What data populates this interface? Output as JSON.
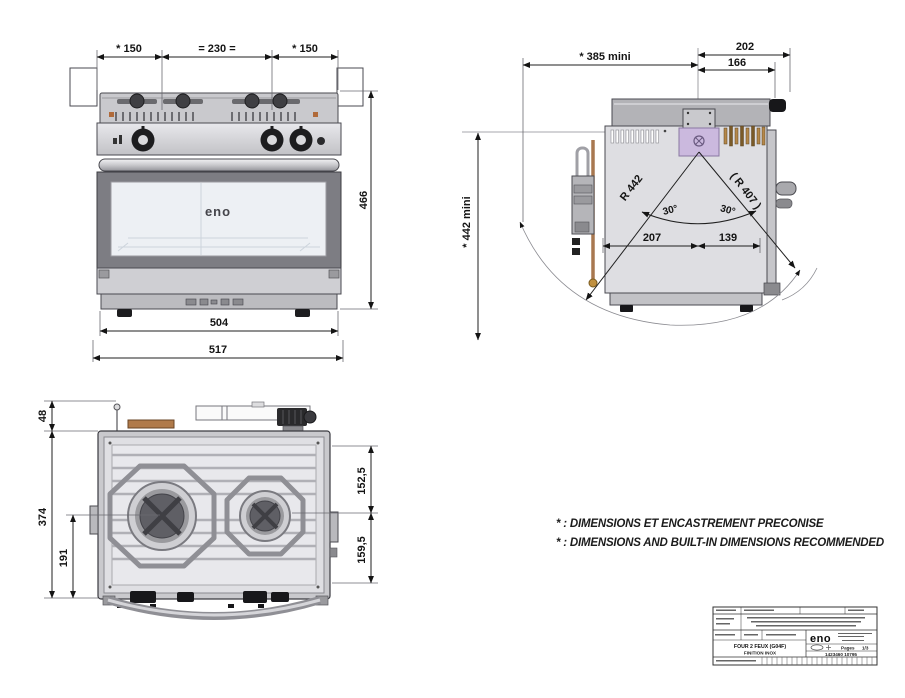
{
  "front_view": {
    "dim_left_burner_offset": "* 150",
    "dim_burner_spacing": "= 230 =",
    "dim_right_burner_offset": "* 150",
    "dim_height": "466",
    "dim_body_width": "504",
    "dim_total_width": "517",
    "door_logo": "eno"
  },
  "side_view": {
    "dim_depth_to_knob": "202",
    "dim_depth_body": "166",
    "dim_builtin_depth": "* 385 mini",
    "dim_builtin_height": "* 442 mini",
    "radius_front": "R 442",
    "radius_rear": "( R 407 )",
    "angle_front": "30°",
    "angle_rear": "30°",
    "dim_pivot_to_front": "207",
    "dim_pivot_to_rear": "139"
  },
  "top_view": {
    "dim_fittings_depth": "48",
    "dim_total_depth": "374",
    "dim_burner_axis": "191",
    "dim_rear_section": "152,5",
    "dim_front_section": "159,5"
  },
  "notes": {
    "line_fr": "* : DIMENSIONS ET ENCASTREMENT PRECONISE",
    "line_en": "* : DIMENSIONS AND BUILT-IN DIMENSIONS RECOMMENDED"
  },
  "title_block": {
    "brand": "eno",
    "product_line1": "FOUR 2 FEUX (G04F)",
    "product_line2": "FINITION INOX",
    "pages_label": "Pages",
    "pages_value": "1/3",
    "part_number": "1423460 10795"
  },
  "colors": {
    "line": "#4a4a50",
    "dimension": "#141414",
    "body_light": "#dedee2",
    "body_mid": "#c6c6ca",
    "door_frame": "#7d7d83",
    "window": "#edf0f4",
    "copper_pipe": "#a87850",
    "gimbal_bracket": "#cbb9de",
    "brass": "#b5884a"
  }
}
